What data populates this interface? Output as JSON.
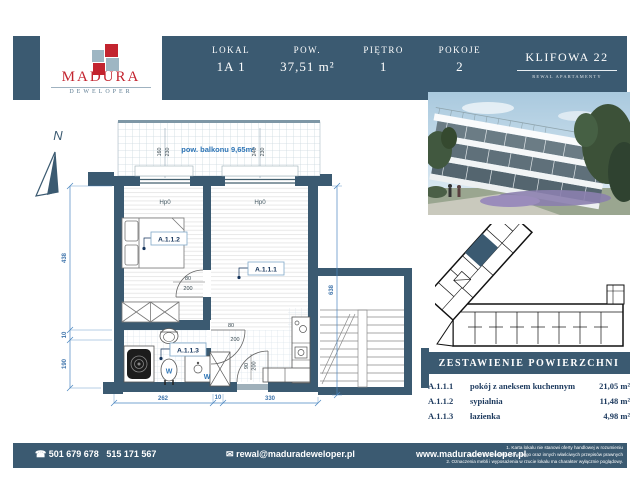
{
  "header": {
    "logo": {
      "name": "MADURA",
      "sub": "DEWELOPER"
    },
    "cols": [
      {
        "label": "LOKAL",
        "value": "1A 1"
      },
      {
        "label": "POW.",
        "value": "37,51 m²"
      },
      {
        "label": "PIĘTRO",
        "value": "1"
      },
      {
        "label": "POKOJE",
        "value": "2"
      }
    ],
    "project": {
      "name": "KLIFOWA 22",
      "sub": "REWAL APARTAMENTY"
    }
  },
  "plan": {
    "north": "N",
    "balcony": "pow. balkonu 9,65m²",
    "win_left_w": "160",
    "win_left_h": "230",
    "win_right_w": "240",
    "win_right_h": "230",
    "hp_left": "Hp0",
    "hp_right": "Hp0",
    "room_living": "A.1.1.1",
    "room_bedroom": "A.1.1.2",
    "room_bath": "A.1.1.3",
    "dim_438": "438",
    "dim_10l": "10",
    "dim_190": "190",
    "dim_262": "262",
    "dim_10b": "10",
    "dim_330": "330",
    "dim_638": "638",
    "door1_w": "80",
    "door1_h": "200",
    "door2_w": "80",
    "door2_h": "200",
    "door3_w": "90",
    "door3_h": "200",
    "washer_label": "W",
    "wardrobe_label": "W"
  },
  "table": {
    "title": "ZESTAWIENIE  POWIERZCHNI",
    "rows": [
      {
        "code": "A.1.1.1",
        "name": "pokój z aneksem kuchennym",
        "area": "21,05 m²"
      },
      {
        "code": "A.1.1.2",
        "name": "sypialnia",
        "area": "11,48 m²"
      },
      {
        "code": "A.1.1.3",
        "name": "łazienka",
        "area": "4,98 m²"
      }
    ]
  },
  "footer": {
    "phone1": "501 679 678",
    "phone2": "515 171 567",
    "email": "rewal@maduradeweloper.pl",
    "website": "www.maduradeweloper.pl",
    "legal1": "1. Karta lokalu nie stanowi oferty handlowej w rozumieniu",
    "legal2": "art. 66 § 1 Kodeksu Cywilnego oraz innych właściwych przepisów prawnych",
    "legal3": "2. Oznaczenia mebli i wyposażenia w rzucie lokalu ma charakter wyłącznie poglądowy."
  },
  "colors": {
    "navy": "#3b5a71",
    "red": "#c3242f",
    "grayblue": "#9eb6c3",
    "dim_blue": "#3f74ab"
  }
}
